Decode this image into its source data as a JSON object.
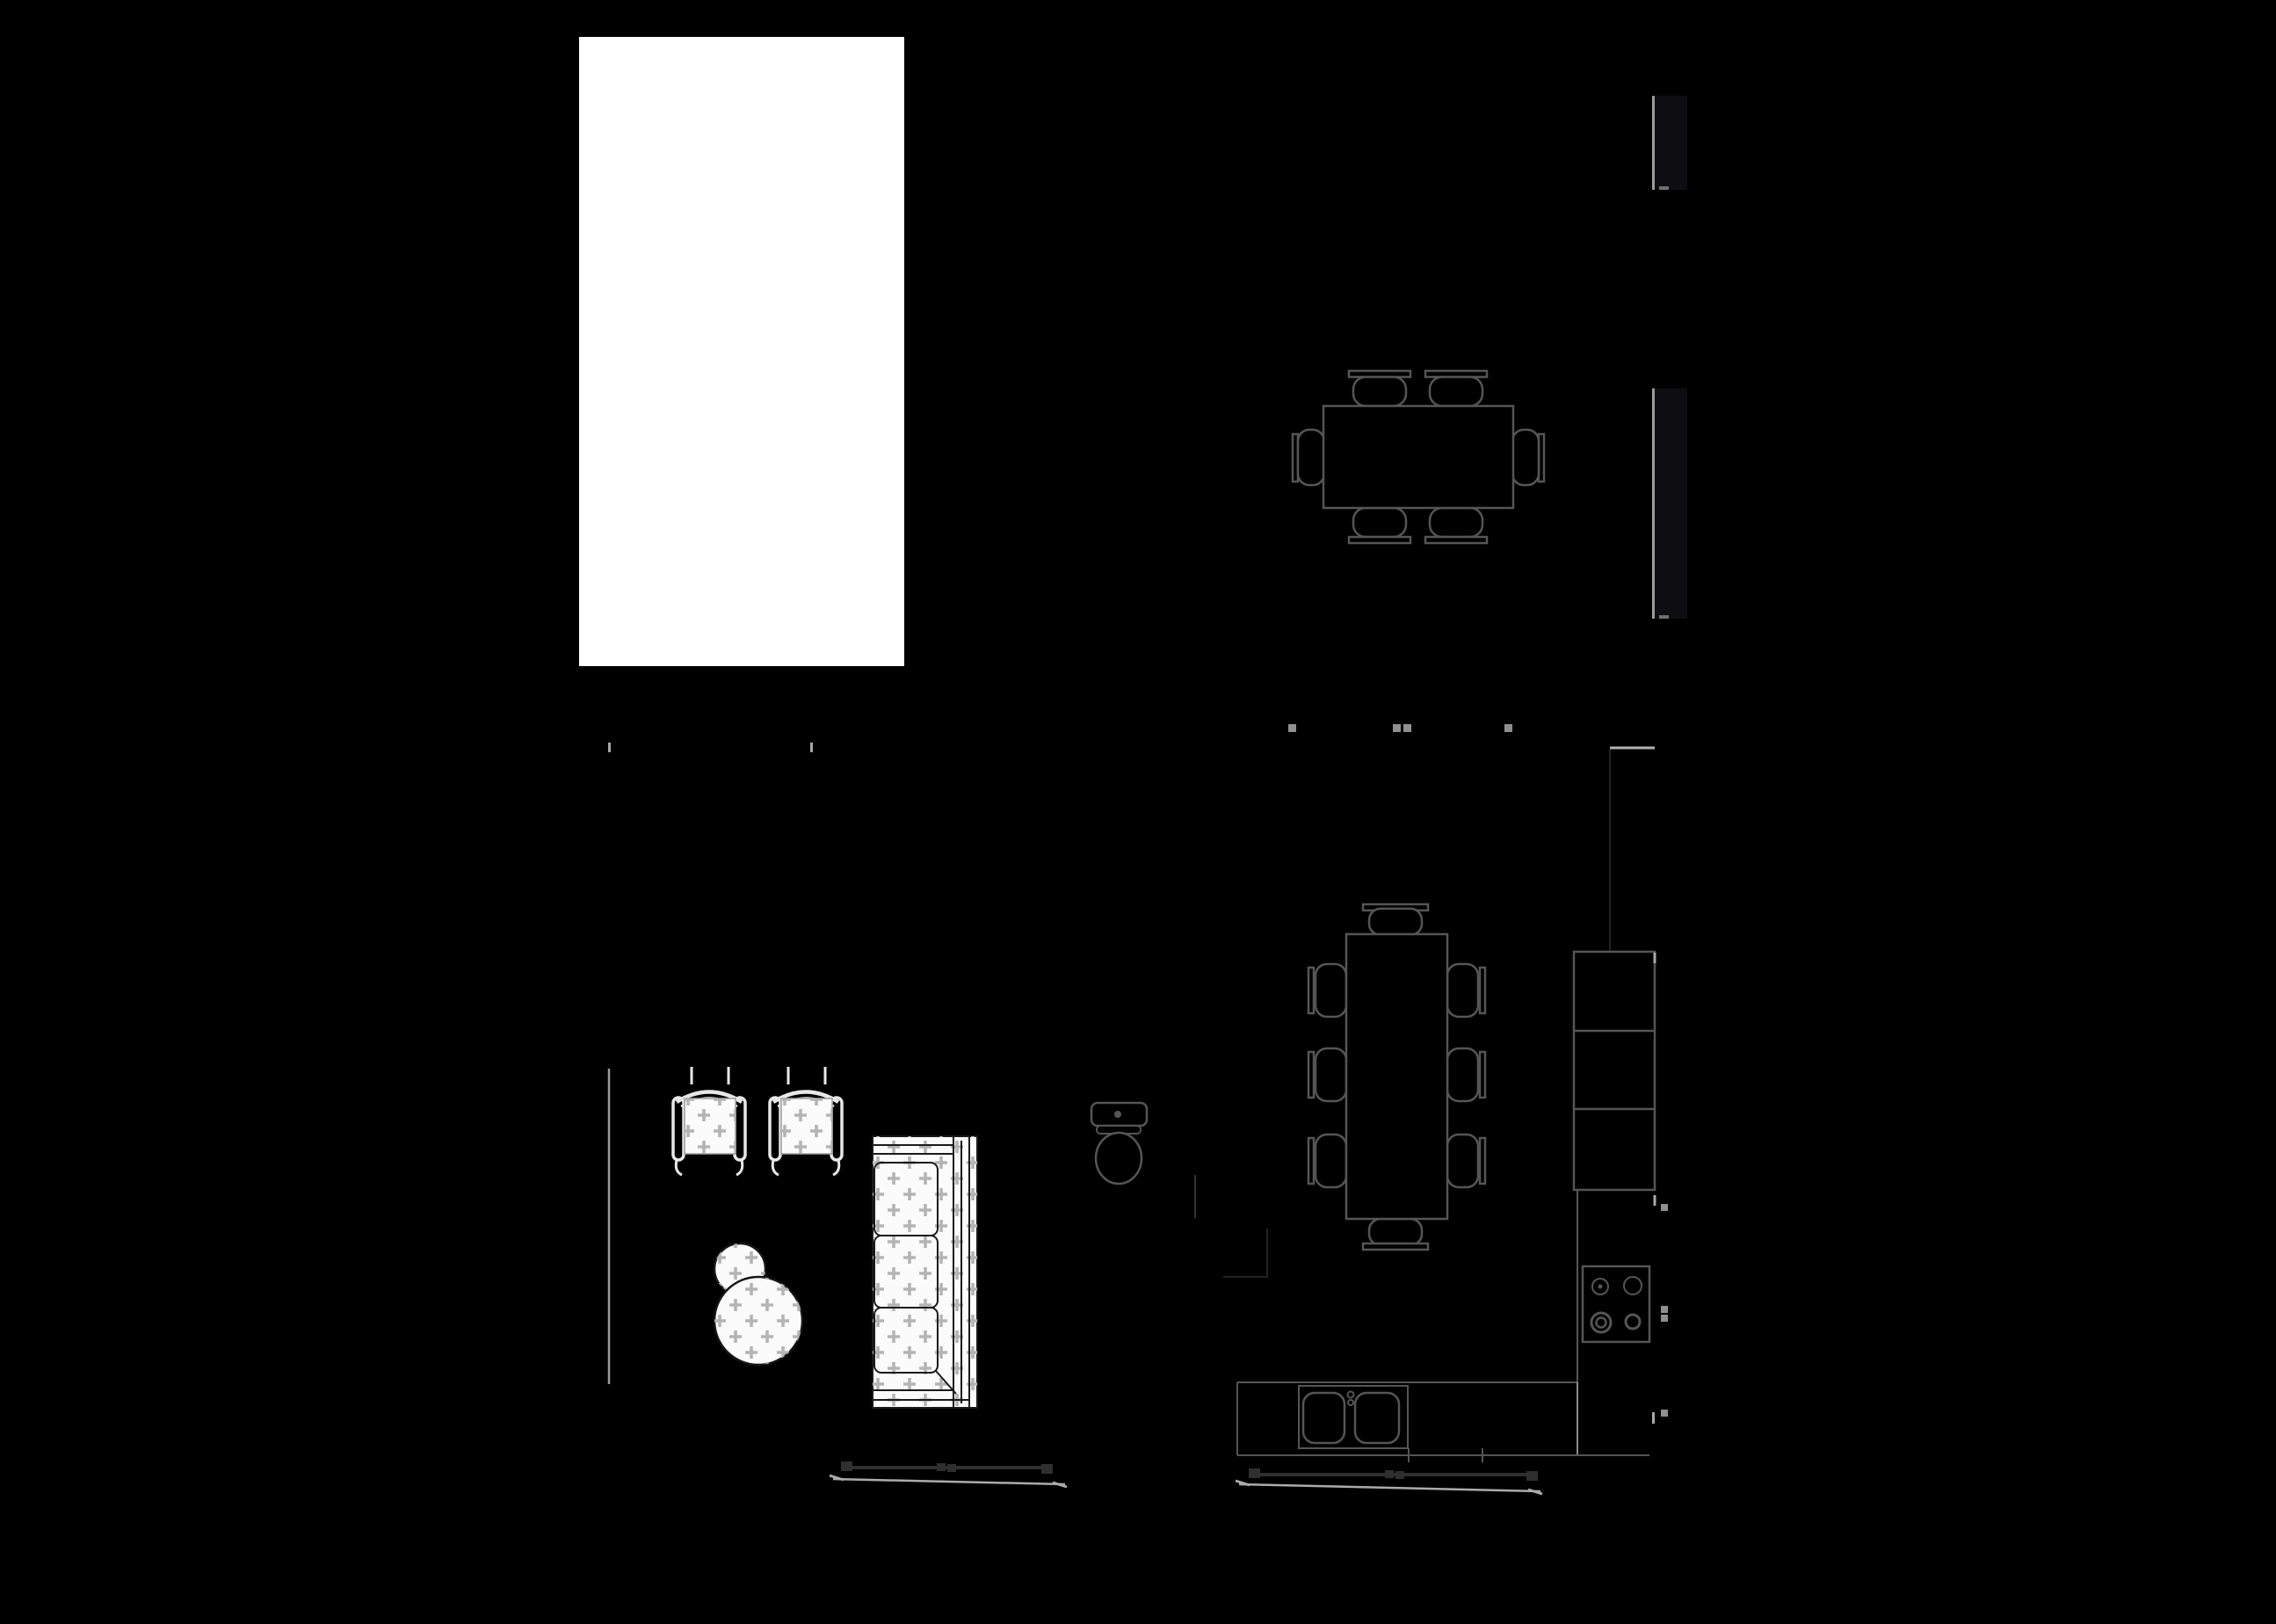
{
  "app": {
    "title": "dark floor plan canvas",
    "background": "#000000"
  },
  "colors": {
    "background": "#000000",
    "room_fill": "#ffffff",
    "bright_furniture_line": "#e9e9e9",
    "upholstery_fill": "#fbfbfb",
    "upholstery_outline": "#1a1a1a",
    "plus_pattern": "#b4b4b4",
    "fixture_line": "#555555",
    "soft_gray_line": "#a9a9a9",
    "window_dark": "#2f2f2f",
    "glass_panel_fill": "#0e0e11",
    "outlet_gray": "#8f8f8f"
  },
  "plan": {
    "rooms": [
      {
        "id": "upper-left-room",
        "kind": "empty white room",
        "fill": "#ffffff"
      }
    ],
    "furniture": [
      {
        "id": "upper-dining-set",
        "type": "dining-table",
        "chairs": 6,
        "zone": "upper unit"
      },
      {
        "id": "glass-door-top",
        "type": "glazed-panel",
        "zone": "right wall"
      },
      {
        "id": "glass-door-mid",
        "type": "glazed-panel",
        "zone": "right wall"
      },
      {
        "id": "armchair-1",
        "type": "armchair",
        "pattern": "plus",
        "zone": "living room"
      },
      {
        "id": "armchair-2",
        "type": "armchair",
        "pattern": "plus",
        "zone": "living room"
      },
      {
        "id": "side-table-small",
        "type": "round-table",
        "pattern": "plus",
        "zone": "living room"
      },
      {
        "id": "side-table-large",
        "type": "round-table",
        "pattern": "plus",
        "zone": "living room"
      },
      {
        "id": "sofa",
        "type": "three-seat-sofa",
        "pattern": "plus",
        "zone": "living room"
      },
      {
        "id": "toilet",
        "type": "toilet",
        "zone": "bathroom"
      },
      {
        "id": "main-dining-set",
        "type": "dining-table",
        "chairs": 8,
        "zone": "dining room"
      },
      {
        "id": "tall-cabinets",
        "type": "cabinet-column",
        "sections": 3,
        "zone": "kitchen"
      },
      {
        "id": "cooktop",
        "type": "cooktop",
        "burners": 4,
        "zone": "kitchen"
      },
      {
        "id": "sink",
        "type": "double-bowl-sink",
        "zone": "kitchen"
      },
      {
        "id": "window-left",
        "type": "sliding-window",
        "zone": "bottom wall"
      },
      {
        "id": "window-right",
        "type": "sliding-window",
        "zone": "bottom wall"
      }
    ],
    "symbols": [
      {
        "id": "outlet-row-wall",
        "count": 4,
        "kind": "socket-marks"
      },
      {
        "id": "outlet-column-kitchen",
        "count": 4,
        "kind": "socket-marks"
      },
      {
        "id": "switch-tick-left",
        "kind": "wall-tick"
      },
      {
        "id": "switch-tick-right",
        "kind": "wall-tick"
      }
    ]
  }
}
